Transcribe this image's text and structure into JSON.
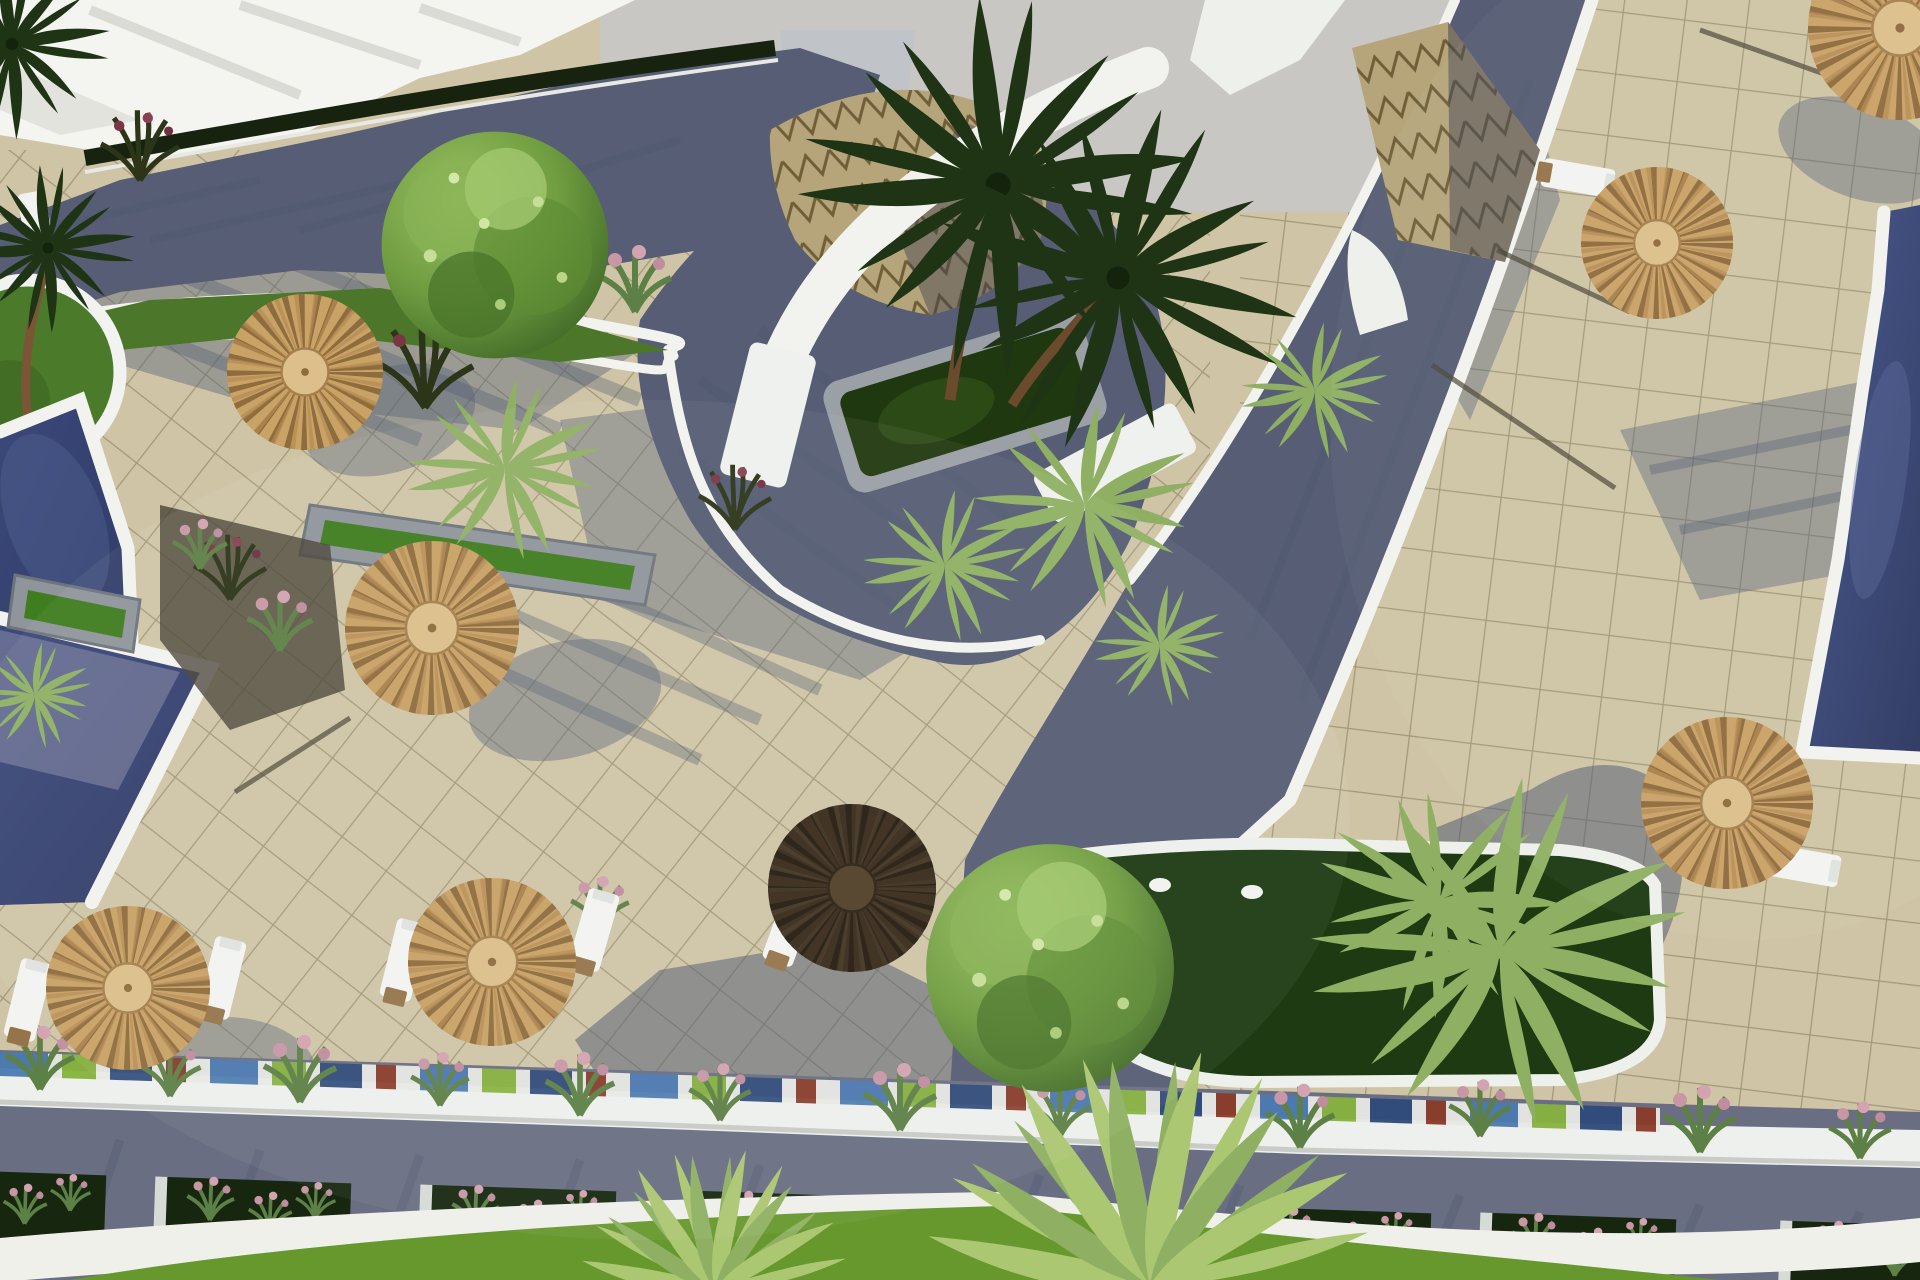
{
  "meta": {
    "title": "Aerial 3D architectural render of a resort pool deck",
    "view": "top-down oblique aerial",
    "render_style": "photorealistic CGI visualization"
  },
  "palette": {
    "sky": "#c8c7c4",
    "canopy_white": "#f4f4f1",
    "plaza_tile": "#cfc5a6",
    "plaza_grid": "#9a9171",
    "road_dark": "#565d74",
    "road_light": "#6a6e82",
    "curb_white": "#f2f3ef",
    "pool_water": "#33406b",
    "pool_reflection": "#9a9ab2",
    "lawn_green": "#67982e",
    "garden_dark": "#1d3a12",
    "verge_green": "#4c7629",
    "umbrella_straw": "#c9a265",
    "umbrella_dark": "#382b1b",
    "stone_planter": "#8f959b",
    "roof_tan": "#b6a57b",
    "wood": "#96744a",
    "flower_pink": "#c897a6"
  },
  "scene": {
    "description": "Top-down render of a resort plaza: beige tiled decks with grid joints, dark cobbled paths, turquoise-navy pools with white copings, straw thatch parasols with sun loungers, palm trees, round shade tree, zigzag-patterned roof canopies, planter troughs, flower boxes along a promenade and lawn strips.",
    "elements": [
      {
        "name": "thatch-umbrella",
        "count": 8
      },
      {
        "name": "sun-lounger",
        "count": 7
      },
      {
        "name": "swimming-pool",
        "count": 3
      },
      {
        "name": "tall-palm-tree",
        "count": 2
      },
      {
        "name": "round-shade-tree",
        "count": 2
      },
      {
        "name": "zigzag-roof-canopy",
        "count": 2
      },
      {
        "name": "white-shade-sail",
        "count": 1
      },
      {
        "name": "central-palm-planter",
        "count": 1
      },
      {
        "name": "junction-garden-bed",
        "count": 1
      },
      {
        "name": "circular-grass-island",
        "count": 1
      },
      {
        "name": "stone-trough-planter",
        "count": 3
      },
      {
        "name": "road-flower-planter-box",
        "count": 7
      },
      {
        "name": "shrub-tuft",
        "count": 14
      },
      {
        "name": "white-figurine",
        "count": 2
      },
      {
        "name": "colored-tile-strip",
        "count": 1
      },
      {
        "name": "promenade-road",
        "count": 1
      },
      {
        "name": "lawn-strip",
        "count": 1
      }
    ]
  }
}
